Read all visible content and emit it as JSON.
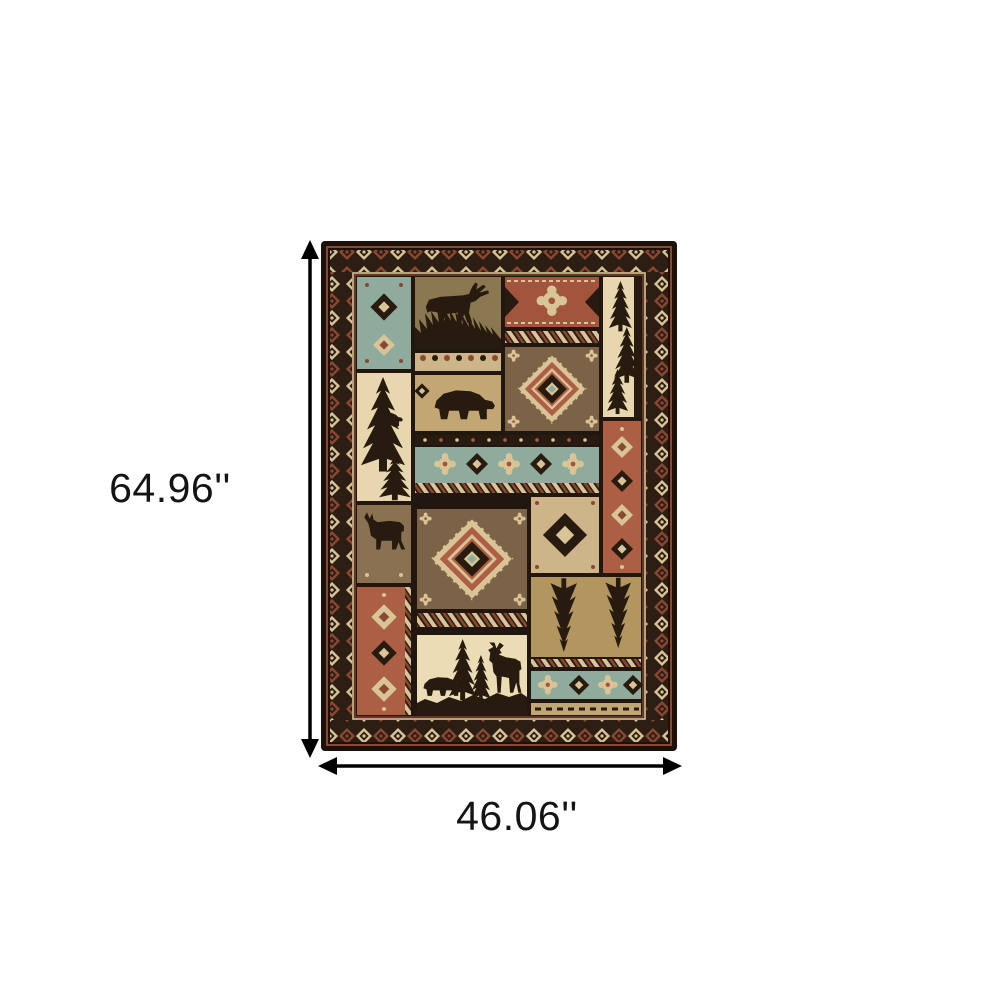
{
  "dimensions": {
    "height_label": "64.96''",
    "width_label": "46.06''"
  },
  "rug_motifs": [
    "moose",
    "bear",
    "deer",
    "pine-tree",
    "diamond-medallion",
    "southwest-geometric-bands",
    "diamond-chain-border"
  ],
  "palette": {
    "page_bg": "#ffffff",
    "arrow": "#000000",
    "label": "#141414",
    "outer": "#1a110a",
    "band": "#2c1e12",
    "darkfield": "#211710",
    "dark": "#261b0e",
    "cream": "#d9c497",
    "cream2": "#e7d6ae",
    "scene": "#ecdcb6",
    "tan": "#c2a674",
    "tan2": "#cdb489",
    "tan3": "#b3965f",
    "olive": "#8c7850",
    "brown": "#7c6347",
    "brown2": "#8a7151",
    "rust": "#a3543c",
    "rust2": "#ad5f45",
    "rustl": "#8a4732",
    "teal": "#8fab9d"
  }
}
